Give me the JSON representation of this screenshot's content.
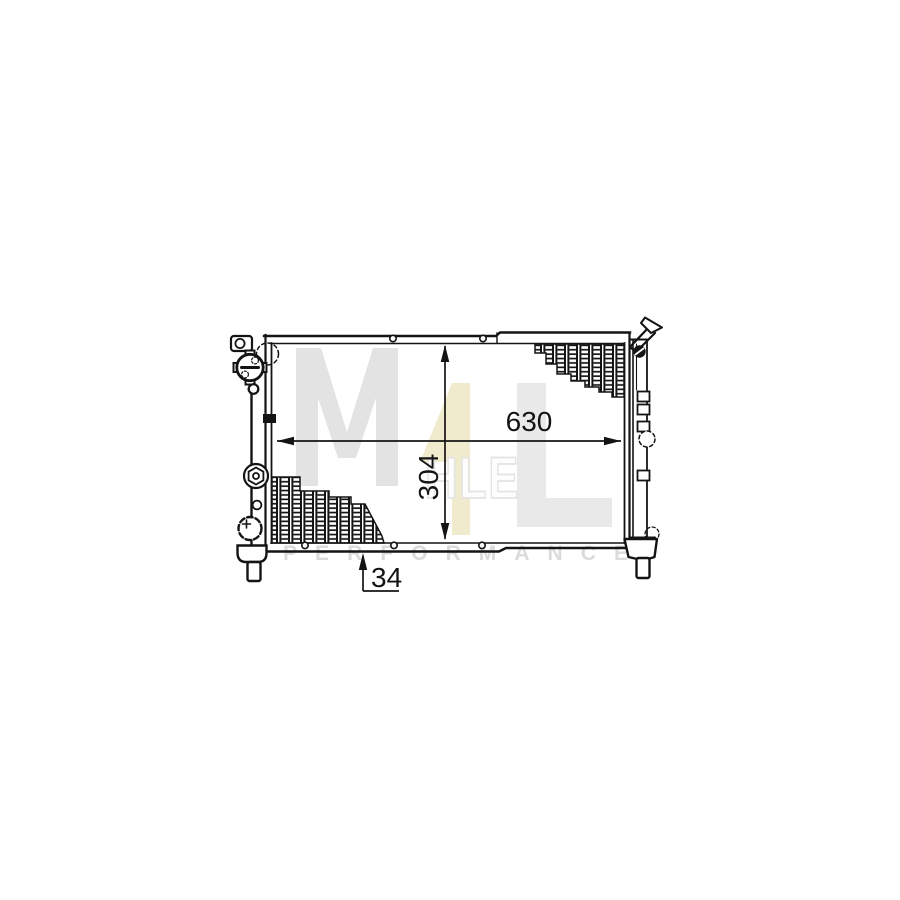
{
  "diagram": {
    "type": "technical-line-drawing",
    "subject": "radiator-dimension-drawing",
    "dimensions": {
      "width": "630",
      "core_height": "304",
      "depth": "34"
    }
  },
  "watermark": {
    "letter_m": "M",
    "letter_4": "4",
    "letters_hle": "HLE",
    "performance": "PERFORMANCE"
  },
  "colors": {
    "background": "#ffffff",
    "line": "#141414",
    "watermark_gray": "#e3e3e3",
    "watermark_gray_light": "#e9e9e9",
    "watermark_yellow": "#f1ebcd",
    "watermark_text": "#dbdbdb"
  }
}
